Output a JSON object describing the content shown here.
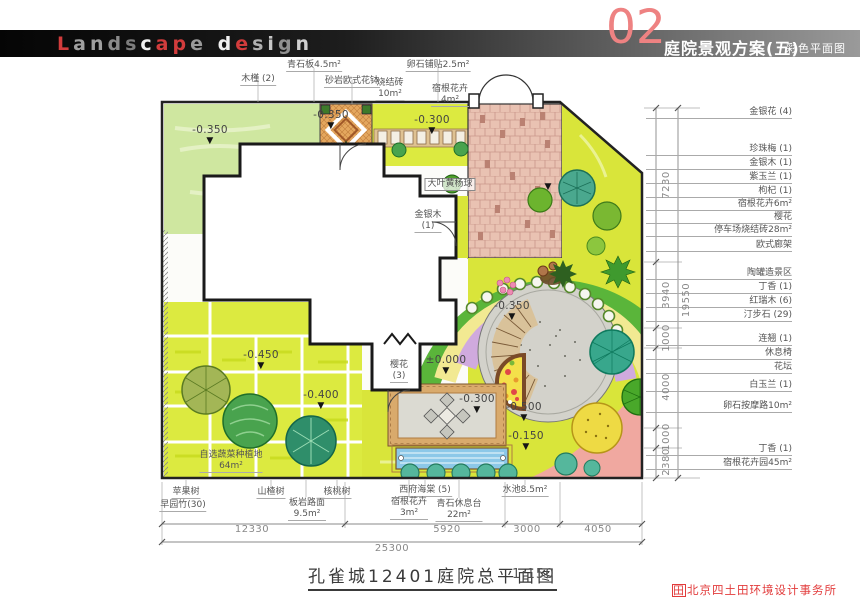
{
  "header": {
    "brand_letters": [
      {
        "t": "L",
        "c": "#d23c3c"
      },
      {
        "t": "a",
        "c": "#a0a0a0"
      },
      {
        "t": "n",
        "c": "#a0a0a0"
      },
      {
        "t": "d",
        "c": "#8a8a8a"
      },
      {
        "t": "s",
        "c": "#7d7d7d"
      },
      {
        "t": "c",
        "c": "#f0f0f0"
      },
      {
        "t": "a",
        "c": "#d23c3c"
      },
      {
        "t": "p",
        "c": "#d23c3c"
      },
      {
        "t": "e",
        "c": "#9a9a9a"
      },
      {
        "t": " ",
        "c": "#000"
      },
      {
        "t": "d",
        "c": "#f0f0f0"
      },
      {
        "t": "e",
        "c": "#d23c3c"
      },
      {
        "t": "s",
        "c": "#b0b0b0"
      },
      {
        "t": "i",
        "c": "#c8c8c8"
      },
      {
        "t": "g",
        "c": "#909090"
      },
      {
        "t": "n",
        "c": "#d0d0d0"
      }
    ],
    "page_number": "02",
    "sheet_title": "庭院景观方案(五)",
    "sheet_subtitle": "彩色平面图"
  },
  "footer": {
    "drawing_title": "孔雀城12401庭院总平面图",
    "scale": "1:150",
    "company": "北京四土田环境设计事务所"
  },
  "icons": {
    "level_marker": "▼",
    "company_logo": "田"
  },
  "plan": {
    "annotations": [
      {
        "t": "top",
        "n": "feature-label",
        "text": "木槿 (2)",
        "x": 258,
        "y": 74
      },
      {
        "t": "top",
        "n": "feature-label",
        "text": "青石板4.5m²",
        "x": 314,
        "y": 60
      },
      {
        "t": "top",
        "n": "feature-label",
        "text": "砂岩欧式花钵",
        "x": 352,
        "y": 76
      },
      {
        "t": "top",
        "n": "feature-label",
        "text": "卵石铺贴2.5m²",
        "x": 438,
        "y": 60
      },
      {
        "t": "top",
        "n": "feature-label",
        "text": "烧结砖\n10m²",
        "x": 390,
        "y": 78
      },
      {
        "t": "top",
        "n": "feature-label",
        "text": "宿根花卉\n4m²",
        "x": 450,
        "y": 84
      },
      {
        "t": "right",
        "n": "legend-label",
        "text": "金银花 (4)",
        "x": 646,
        "y": 107
      },
      {
        "t": "right",
        "n": "legend-label",
        "text": "珍珠梅 (1)",
        "x": 646,
        "y": 144
      },
      {
        "t": "right",
        "n": "legend-label",
        "text": "金银木 (1)",
        "x": 646,
        "y": 158
      },
      {
        "t": "right",
        "n": "legend-label",
        "text": "紫玉兰 (1)",
        "x": 646,
        "y": 172
      },
      {
        "t": "right",
        "n": "legend-label",
        "text": "枸杞 (1)",
        "x": 646,
        "y": 186
      },
      {
        "t": "right",
        "n": "legend-label",
        "text": "宿根花卉6m²",
        "x": 646,
        "y": 199
      },
      {
        "t": "right",
        "n": "legend-label",
        "text": "樱花",
        "x": 646,
        "y": 212
      },
      {
        "t": "right",
        "n": "legend-label",
        "text": "停车场烧结砖28m²",
        "x": 646,
        "y": 225
      },
      {
        "t": "right",
        "n": "legend-label",
        "text": "欧式廊架",
        "x": 646,
        "y": 240
      },
      {
        "t": "right",
        "n": "legend-label",
        "text": "陶罐造景区",
        "x": 646,
        "y": 268
      },
      {
        "t": "right",
        "n": "legend-label",
        "text": "丁香 (1)",
        "x": 646,
        "y": 282
      },
      {
        "t": "right",
        "n": "legend-label",
        "text": "红瑞木 (6)",
        "x": 646,
        "y": 296
      },
      {
        "t": "right",
        "n": "legend-label",
        "text": "汀步石 (29)",
        "x": 646,
        "y": 310
      },
      {
        "t": "right",
        "n": "legend-label",
        "text": "连翘 (1)",
        "x": 646,
        "y": 334
      },
      {
        "t": "right",
        "n": "legend-label",
        "text": "休息椅",
        "x": 646,
        "y": 348
      },
      {
        "t": "right",
        "n": "legend-label",
        "text": "花坛",
        "x": 646,
        "y": 362
      },
      {
        "t": "right",
        "n": "legend-label",
        "text": "白玉兰 (1)",
        "x": 646,
        "y": 380
      },
      {
        "t": "right",
        "n": "legend-label",
        "text": "卵石按摩路10m²",
        "x": 646,
        "y": 401
      },
      {
        "t": "right",
        "n": "legend-label",
        "text": "丁香 (1)",
        "x": 646,
        "y": 444
      },
      {
        "t": "right",
        "n": "legend-label",
        "text": "宿根花卉园45m²",
        "x": 646,
        "y": 458
      },
      {
        "t": "bottom",
        "n": "feature-label",
        "text": "苹果树",
        "x": 186,
        "y": 487
      },
      {
        "t": "bottom",
        "n": "feature-label",
        "text": "早园竹(30)",
        "x": 183,
        "y": 500
      },
      {
        "t": "bottom",
        "n": "feature-label",
        "text": "山楂树",
        "x": 271,
        "y": 487
      },
      {
        "t": "bottom",
        "n": "feature-label",
        "text": "板岩路面\n9.5m²",
        "x": 307,
        "y": 498
      },
      {
        "t": "bottom",
        "n": "feature-label",
        "text": "核桃树",
        "x": 337,
        "y": 487
      },
      {
        "t": "bottom",
        "n": "feature-label",
        "text": "西府海棠 (5)",
        "x": 425,
        "y": 485
      },
      {
        "t": "bottom",
        "n": "feature-label",
        "text": "宿根花卉\n3m²",
        "x": 409,
        "y": 497
      },
      {
        "t": "bottom",
        "n": "feature-label",
        "text": "青石休息台\n22m²",
        "x": 459,
        "y": 499
      },
      {
        "t": "bottom",
        "n": "feature-label",
        "text": "水池8.5m²",
        "x": 525,
        "y": 485
      },
      {
        "t": "level",
        "n": "level-marker",
        "text": "-0.350",
        "x": 210,
        "y": 124
      },
      {
        "t": "level",
        "n": "level-marker",
        "text": "-0.350",
        "x": 331,
        "y": 109
      },
      {
        "t": "level",
        "n": "level-marker",
        "text": "-0.300",
        "x": 432,
        "y": 114
      },
      {
        "t": "tri",
        "n": "level-marker",
        "text": "",
        "x": 548,
        "y": 172
      },
      {
        "t": "level",
        "n": "level-marker",
        "text": "-0.450",
        "x": 261,
        "y": 349
      },
      {
        "t": "level",
        "n": "level-marker",
        "text": "-0.400",
        "x": 321,
        "y": 389
      },
      {
        "t": "level",
        "n": "level-marker",
        "text": "±0.000",
        "x": 446,
        "y": 354
      },
      {
        "t": "level",
        "n": "level-marker",
        "text": "-0.350",
        "x": 512,
        "y": 300
      },
      {
        "t": "level",
        "n": "level-marker",
        "text": "-0.300",
        "x": 477,
        "y": 393
      },
      {
        "t": "level",
        "n": "level-marker",
        "text": "-0.500",
        "x": 524,
        "y": 401
      },
      {
        "t": "level",
        "n": "level-marker",
        "text": "-0.150",
        "x": 526,
        "y": 430
      },
      {
        "t": "box",
        "n": "feature-label",
        "text": "大叶黄杨球",
        "x": 450,
        "y": 178
      },
      {
        "t": "plain",
        "n": "feature-label",
        "text": "金银木\n(1)",
        "x": 428,
        "y": 210
      },
      {
        "t": "plain",
        "n": "feature-label",
        "text": "樱花\n(3)",
        "x": 399,
        "y": 360
      },
      {
        "t": "plain",
        "n": "feature-label",
        "text": "自选蔬菜种植地\n64m²",
        "x": 231,
        "y": 450
      },
      {
        "t": "dim",
        "n": "dimension-label",
        "text": "12330",
        "x": 252,
        "y": 524
      },
      {
        "t": "dim",
        "n": "dimension-label",
        "text": "5920",
        "x": 447,
        "y": 524
      },
      {
        "t": "dim",
        "n": "dimension-label",
        "text": "3000",
        "x": 527,
        "y": 524
      },
      {
        "t": "dim",
        "n": "dimension-label",
        "text": "4050",
        "x": 598,
        "y": 524
      },
      {
        "t": "dim",
        "n": "dimension-label",
        "text": "25300",
        "x": 392,
        "y": 543
      },
      {
        "t": "dimv",
        "n": "dimension-label",
        "text": "7230",
        "x": 667,
        "y": 185
      },
      {
        "t": "dimv",
        "n": "dimension-label",
        "text": "3940",
        "x": 667,
        "y": 295
      },
      {
        "t": "dimv",
        "n": "dimension-label",
        "text": "19550",
        "x": 687,
        "y": 300
      },
      {
        "t": "dimv",
        "n": "dimension-label",
        "text": "1000",
        "x": 667,
        "y": 338
      },
      {
        "t": "dimv",
        "n": "dimension-label",
        "text": "4000",
        "x": 667,
        "y": 387
      },
      {
        "t": "dimv",
        "n": "dimension-label",
        "text": "1000",
        "x": 667,
        "y": 437
      },
      {
        "t": "dimv",
        "n": "dimension-label",
        "text": "2380",
        "x": 667,
        "y": 462
      }
    ]
  }
}
